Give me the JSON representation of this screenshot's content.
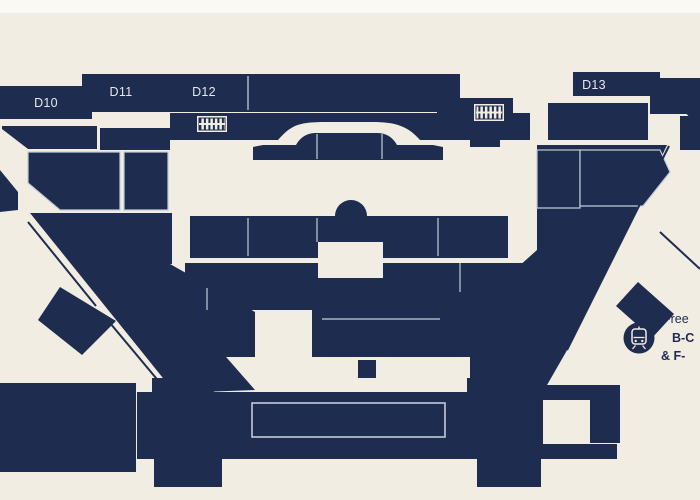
{
  "map": {
    "kind": "airport-concourse-floor-map",
    "gates": {
      "d10": "D10",
      "d11": "D11",
      "d12": "D12",
      "d13": "D13"
    },
    "train_note": {
      "line1": "Free",
      "line2": "B-C",
      "line3": "& F-"
    },
    "icons": {
      "train": "train-station-icon",
      "walkway_west": "moving-walkway-icon",
      "walkway_east": "moving-walkway-icon"
    },
    "colors": {
      "navy": "#1e2c50",
      "cream": "#f2ede3",
      "divider": "#c3cad8",
      "label": "#e6e8f0"
    }
  }
}
